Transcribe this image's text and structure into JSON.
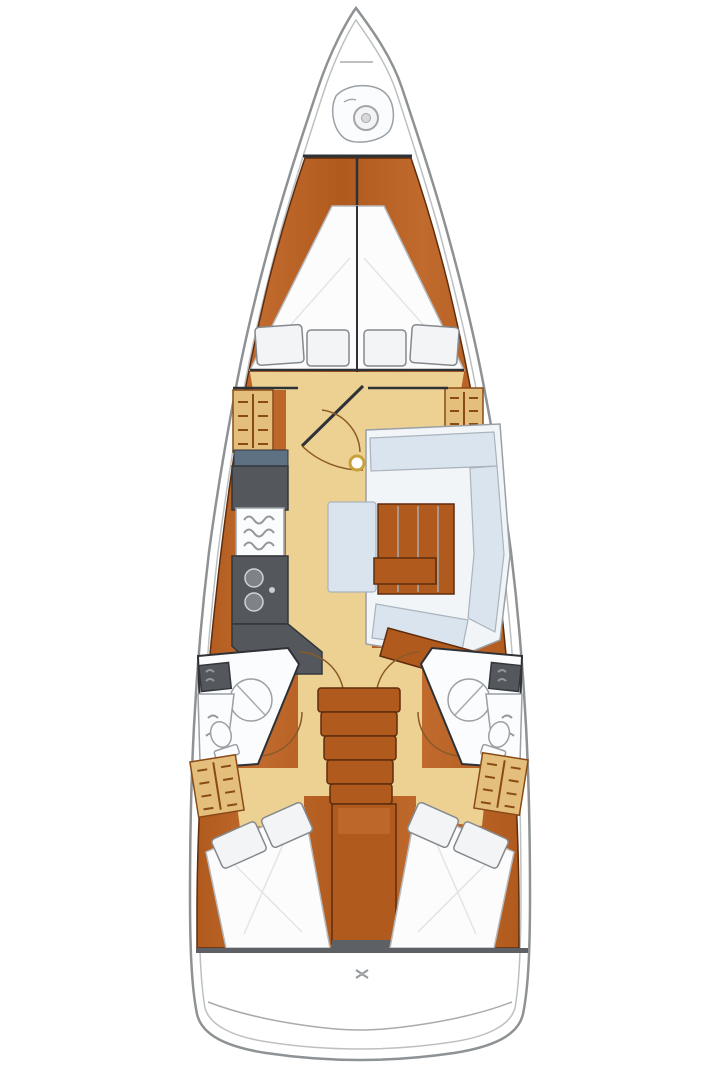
{
  "diagram": {
    "type": "boat-floor-plan",
    "subject": "top-down interior layout plan of a sailing yacht, bow at top and stern at bottom",
    "regions": [
      "bow anchor locker with windlass",
      "forward cabin V-berth with four pillows",
      "forward cabin side lockers",
      "forward cabin door with swing arc",
      "mast step",
      "galley with stove and twin sinks (port)",
      "U-shaped salon settee with wooden table (starboard)",
      "center bench seat",
      "nav locker",
      "head with shower and toilet (port)",
      "head with shower and toilet (starboard)",
      "companionway steps",
      "engine compartment",
      "aft double cabin (port)",
      "aft double cabin (starboard)",
      "aft drawer units",
      "transom and swim platform"
    ]
  },
  "colors": {
    "hull-line": "#8e9294",
    "wood": "#b05a1e",
    "wood-dark": "#5f2c0c",
    "wood-light": "#c06a2e",
    "floor": "#ecd193",
    "locker": "#e4bf7c",
    "locker-line": "#8a4a16",
    "counter": "#54585d",
    "counter-dark": "#33373b",
    "steel-strip": "#5e7183",
    "settee": "#d9e4ef",
    "settee-back": "#f2f5f8",
    "bed": "#fcfcfd",
    "bed-stroke": "#b6babd",
    "pillow": "#f3f4f6",
    "pillow-stroke": "#85898d",
    "fixture-stroke": "#9aa0a5",
    "dark-line": "#2e3236",
    "arc": "#8a5a28",
    "mast-ring": "#c9a13b"
  }
}
